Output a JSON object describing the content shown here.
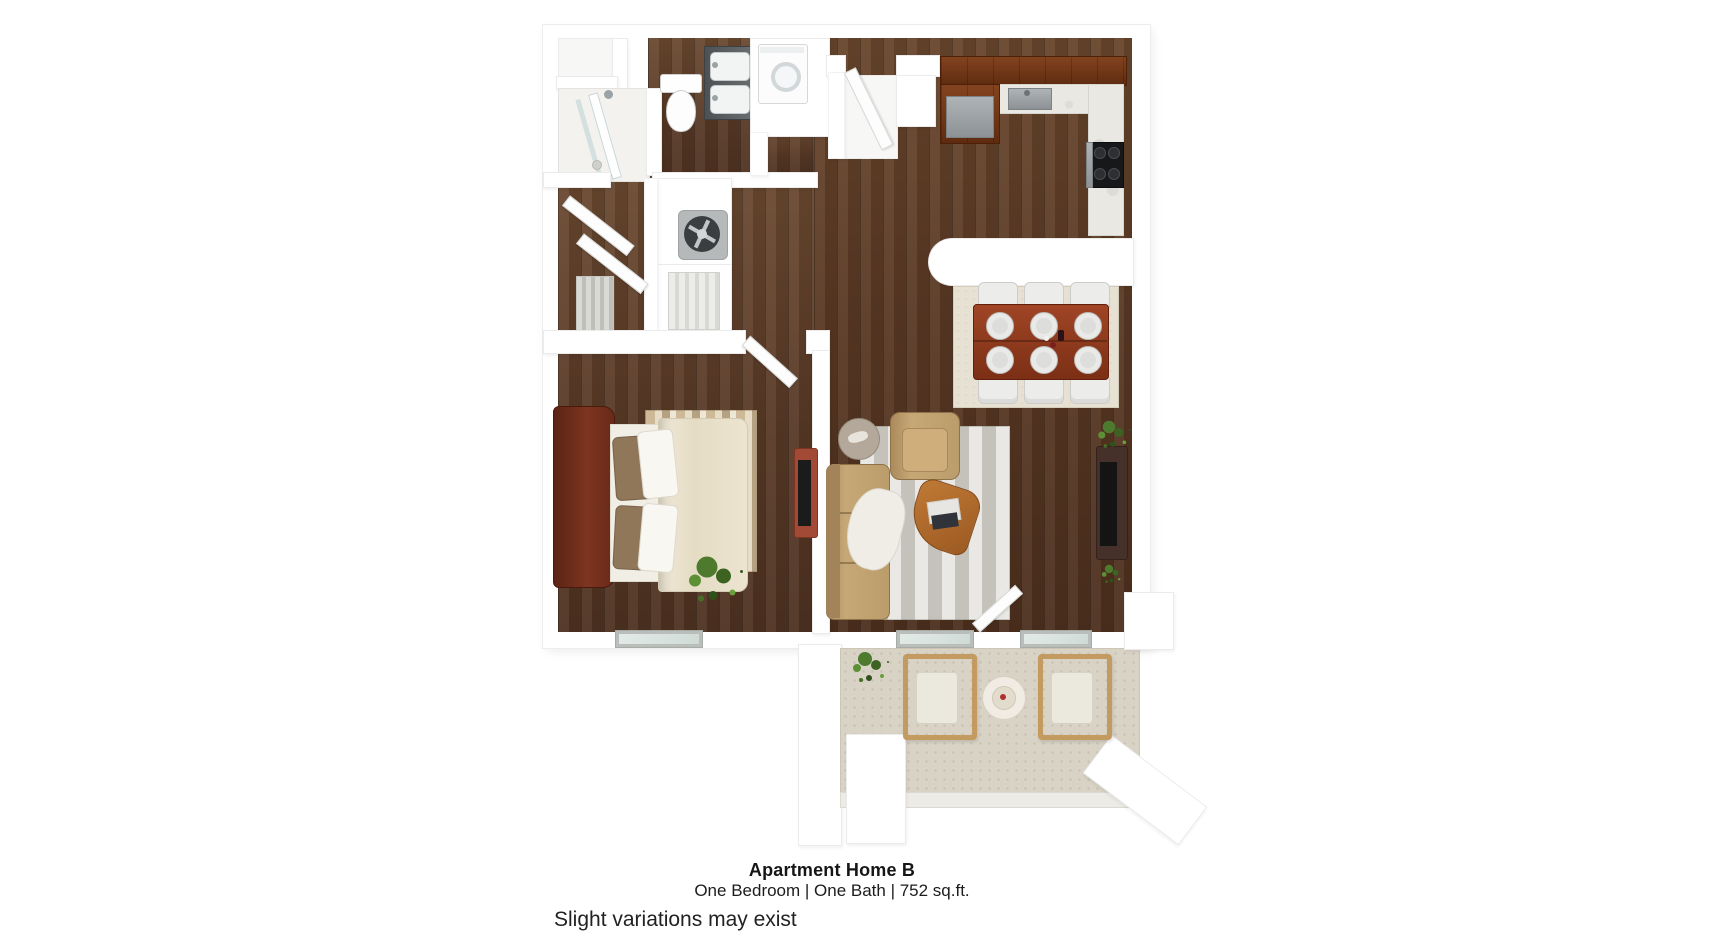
{
  "page": {
    "background_color": "#ffffff"
  },
  "caption": {
    "title": "Apartment Home B",
    "subtitle": "One Bedroom | One Bath | 752 sq.ft.",
    "disclaimer": "Slight variations may exist"
  },
  "floor_plan": {
    "render_style": "3d-top-down-render",
    "rooms": [
      "bathroom",
      "walk-in-shower",
      "hall-closet",
      "laundry-closet",
      "hvac-closet",
      "linen-closet",
      "entry-vestibule",
      "kitchen",
      "dining-area",
      "living-room",
      "bedroom",
      "patio"
    ],
    "palette": {
      "wall": "#ffffff",
      "wood_floor": "#5d3d27",
      "kitchen_cabinet": "#6e3315",
      "countertop": "#eae8e2",
      "dining_table": "#8e3a22",
      "sofa": "#c6a877",
      "bed_duvet": "#eae2cd",
      "headboard": "#6f2d1b",
      "bedroom_rug": "#d8c7ab",
      "living_rug": "#cfccc5",
      "patio_floor": "#d9d3c6",
      "plant_green": "#4e7a2d",
      "range": "#17181a"
    }
  }
}
